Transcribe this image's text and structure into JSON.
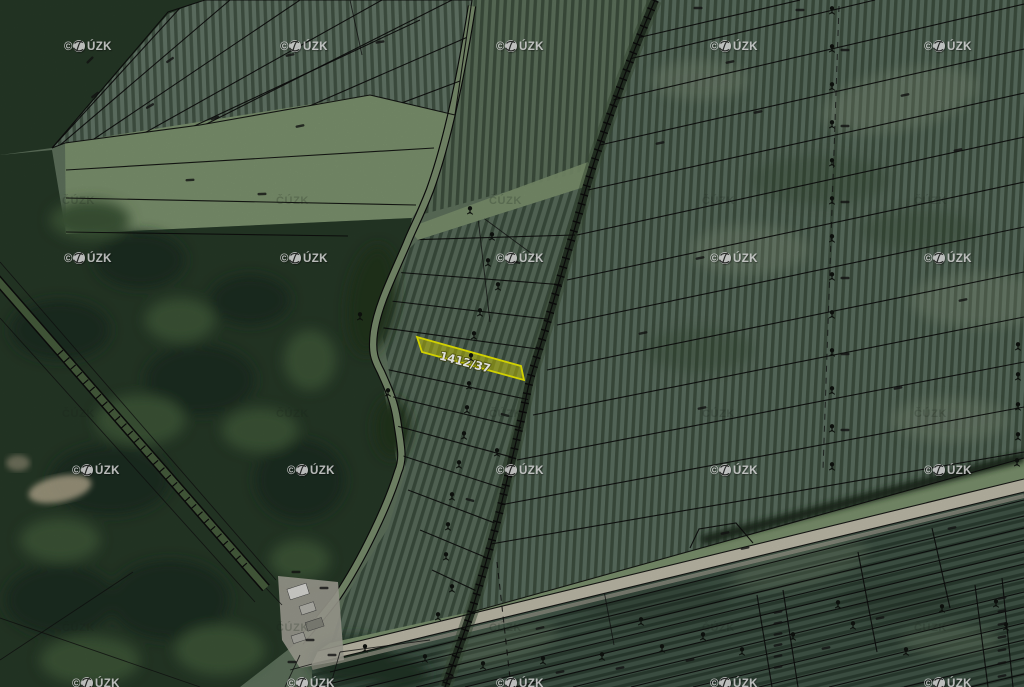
{
  "window": {
    "type": "cadastral-orthophoto-map-view",
    "width": 1024,
    "height": 687
  },
  "map": {
    "highlighted_parcel": {
      "label": "1412/37",
      "fill": "#e8e800",
      "fill_opacity": 0.45,
      "stroke": "#f0f000",
      "label_color": "#ffffff"
    },
    "watermark": {
      "full": "© ČÚZK",
      "prefix": "©",
      "suffix": "ÚZK",
      "faint": "ČÚZK",
      "color": "#f4f4f4",
      "positions_strong": [
        [
          64,
          46
        ],
        [
          280,
          46
        ],
        [
          496,
          46
        ],
        [
          710,
          46
        ],
        [
          924,
          46
        ],
        [
          64,
          258
        ],
        [
          280,
          258
        ],
        [
          496,
          258
        ],
        [
          710,
          258
        ],
        [
          924,
          258
        ],
        [
          72,
          470
        ],
        [
          287,
          470
        ],
        [
          496,
          470
        ],
        [
          710,
          470
        ],
        [
          924,
          470
        ],
        [
          72,
          683
        ],
        [
          287,
          683
        ],
        [
          496,
          683
        ],
        [
          710,
          683
        ],
        [
          924,
          683
        ]
      ],
      "positions_faint": [
        [
          62,
          200
        ],
        [
          276,
          200
        ],
        [
          489,
          200
        ],
        [
          702,
          200
        ],
        [
          914,
          200
        ],
        [
          62,
          413
        ],
        [
          276,
          413
        ],
        [
          489,
          413
        ],
        [
          702,
          413
        ],
        [
          914,
          413
        ],
        [
          62,
          627
        ],
        [
          276,
          627
        ],
        [
          489,
          627
        ],
        [
          702,
          627
        ],
        [
          914,
          627
        ]
      ]
    },
    "symbols": {
      "tree_positions": [
        [
          470,
          212
        ],
        [
          492,
          238
        ],
        [
          488,
          264
        ],
        [
          498,
          288
        ],
        [
          480,
          314
        ],
        [
          474,
          337
        ],
        [
          471,
          359
        ],
        [
          469,
          387
        ],
        [
          467,
          411
        ],
        [
          464,
          437
        ],
        [
          497,
          454
        ],
        [
          459,
          466
        ],
        [
          452,
          498
        ],
        [
          448,
          528
        ],
        [
          446,
          558
        ],
        [
          452,
          590
        ],
        [
          438,
          618
        ],
        [
          360,
          318
        ],
        [
          388,
          394
        ],
        [
          832,
          12
        ],
        [
          832,
          50
        ],
        [
          832,
          88
        ],
        [
          832,
          126
        ],
        [
          832,
          164
        ],
        [
          832,
          202
        ],
        [
          832,
          240
        ],
        [
          832,
          278
        ],
        [
          832,
          316
        ],
        [
          832,
          354
        ],
        [
          832,
          392
        ],
        [
          832,
          430
        ],
        [
          832,
          468
        ],
        [
          1018,
          348
        ],
        [
          1018,
          378
        ],
        [
          1018,
          408
        ],
        [
          1018,
          438
        ],
        [
          1017,
          464
        ],
        [
          365,
          650
        ],
        [
          425,
          660
        ],
        [
          483,
          667
        ],
        [
          543,
          662
        ],
        [
          602,
          658
        ],
        [
          662,
          650
        ],
        [
          703,
          638
        ],
        [
          641,
          623
        ],
        [
          838,
          606
        ],
        [
          853,
          627
        ],
        [
          942,
          610
        ],
        [
          996,
          605
        ],
        [
          1006,
          628
        ],
        [
          906,
          653
        ],
        [
          742,
          653
        ],
        [
          793,
          638
        ]
      ],
      "tiny_label_positions": [
        [
          95,
          95,
          -38
        ],
        [
          150,
          106,
          -30
        ],
        [
          215,
          118,
          -20
        ],
        [
          90,
          60,
          -45
        ],
        [
          290,
          55,
          -12
        ],
        [
          380,
          42,
          -10
        ],
        [
          300,
          126,
          -12
        ],
        [
          170,
          60,
          -35
        ],
        [
          190,
          180,
          -3
        ],
        [
          262,
          194,
          -2
        ],
        [
          698,
          8,
          0
        ],
        [
          800,
          10,
          0
        ],
        [
          730,
          62,
          -12
        ],
        [
          758,
          112,
          -12
        ],
        [
          660,
          143,
          -12
        ],
        [
          905,
          95,
          -12
        ],
        [
          958,
          150,
          -12
        ],
        [
          700,
          258,
          -12
        ],
        [
          643,
          333,
          -12
        ],
        [
          702,
          408,
          -12
        ],
        [
          963,
          300,
          -12
        ],
        [
          898,
          388,
          -12
        ],
        [
          845,
          50,
          0
        ],
        [
          845,
          126,
          0
        ],
        [
          845,
          202,
          0
        ],
        [
          845,
          278,
          0
        ],
        [
          845,
          354,
          0
        ],
        [
          845,
          430,
          0
        ],
        [
          516,
          262,
          15
        ],
        [
          505,
          415,
          15
        ],
        [
          470,
          500,
          15
        ],
        [
          778,
          612,
          -12
        ],
        [
          778,
          623,
          -12
        ],
        [
          778,
          634,
          -12
        ],
        [
          778,
          645,
          -12
        ],
        [
          778,
          656,
          -12
        ],
        [
          778,
          667,
          -12
        ],
        [
          1002,
          598,
          -12
        ],
        [
          1002,
          611,
          -12
        ],
        [
          1002,
          624,
          -12
        ],
        [
          1002,
          637,
          -12
        ],
        [
          1002,
          650,
          -12
        ],
        [
          1002,
          663,
          -12
        ],
        [
          1002,
          676,
          -12
        ],
        [
          725,
          533,
          -12
        ],
        [
          745,
          548,
          -12
        ],
        [
          952,
          528,
          -12
        ],
        [
          880,
          618,
          -12
        ],
        [
          826,
          648,
          -12
        ],
        [
          690,
          660,
          -12
        ],
        [
          620,
          668,
          -12
        ],
        [
          560,
          672,
          -12
        ],
        [
          450,
          678,
          -12
        ],
        [
          540,
          628,
          -13
        ],
        [
          296,
          572,
          0
        ],
        [
          324,
          588,
          0
        ],
        [
          310,
          640,
          0
        ],
        [
          332,
          655,
          0
        ],
        [
          292,
          662,
          0
        ]
      ]
    },
    "palette": {
      "field": "#61755f",
      "field_right": "#5e7263",
      "field_below_road": "#43584a",
      "orchard_row": "#1f3020",
      "forest": "#273a28",
      "forest_dark_blob": "#1c2e20",
      "forest_light_blob": "#3e5639",
      "grass": "#7f9671",
      "road": "#c4c0ae",
      "dirt_clearing": "#b6ab90",
      "alley_trees": "#202c20",
      "boundary_line": "#0c0c0c",
      "building_roof_light": "#dededa",
      "building_roof_mid": "#b9b9b1",
      "building_roof_dark": "#87887e"
    }
  }
}
